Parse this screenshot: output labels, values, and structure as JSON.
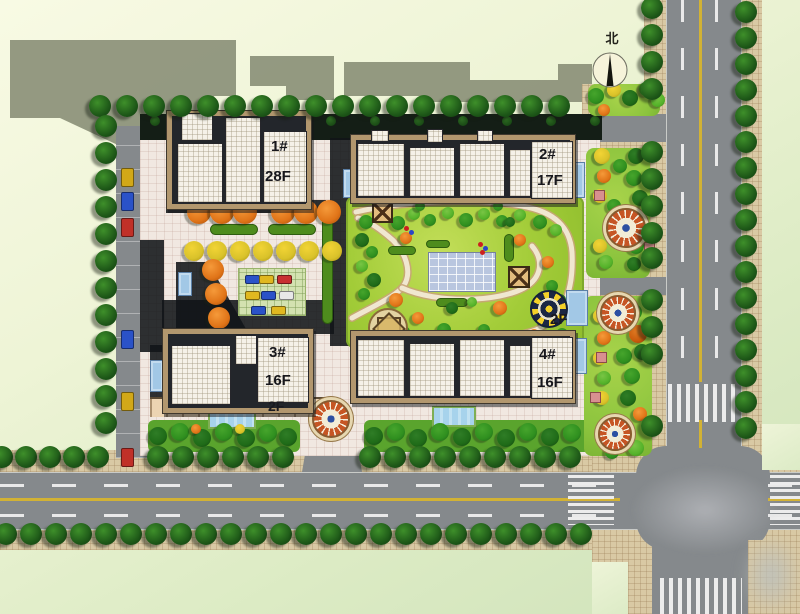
{
  "compass": {
    "label": "北"
  },
  "buildings": [
    {
      "id": "building-1",
      "number_label": "1#",
      "floors_label": "28F"
    },
    {
      "id": "building-2",
      "number_label": "2#",
      "floors_label": "17F"
    },
    {
      "id": "building-3",
      "number_label": "3#",
      "floors_label": "16F"
    },
    {
      "id": "building-4",
      "number_label": "4#",
      "floors_label": "16F"
    }
  ],
  "podium_labels": [
    {
      "id": "podium-label-south",
      "label": "2F"
    },
    {
      "id": "podium-label-east",
      "label": "2F"
    }
  ],
  "colors": {
    "road_gray": "#85898c",
    "lane_marking_yellow": "#d2b234",
    "sidewalk_tile_tan": "#d9c9a4",
    "plaza_tile_pink": "#f1e8e1",
    "building_roof_white": "#f5f1e8",
    "building_frame_tan": "#b2976e",
    "central_lawn_green": "#a2cc38",
    "street_tree_green": "#1c5517",
    "autumn_tree_orange": "#e07418",
    "autumn_tree_yellow": "#d9c22a",
    "canopy_blue": "#a2c8e6",
    "pool_blue": "#b9c6df",
    "offsite_shadow_green_gray": "#8b9078",
    "cast_shadow_dark": "#15181c"
  }
}
